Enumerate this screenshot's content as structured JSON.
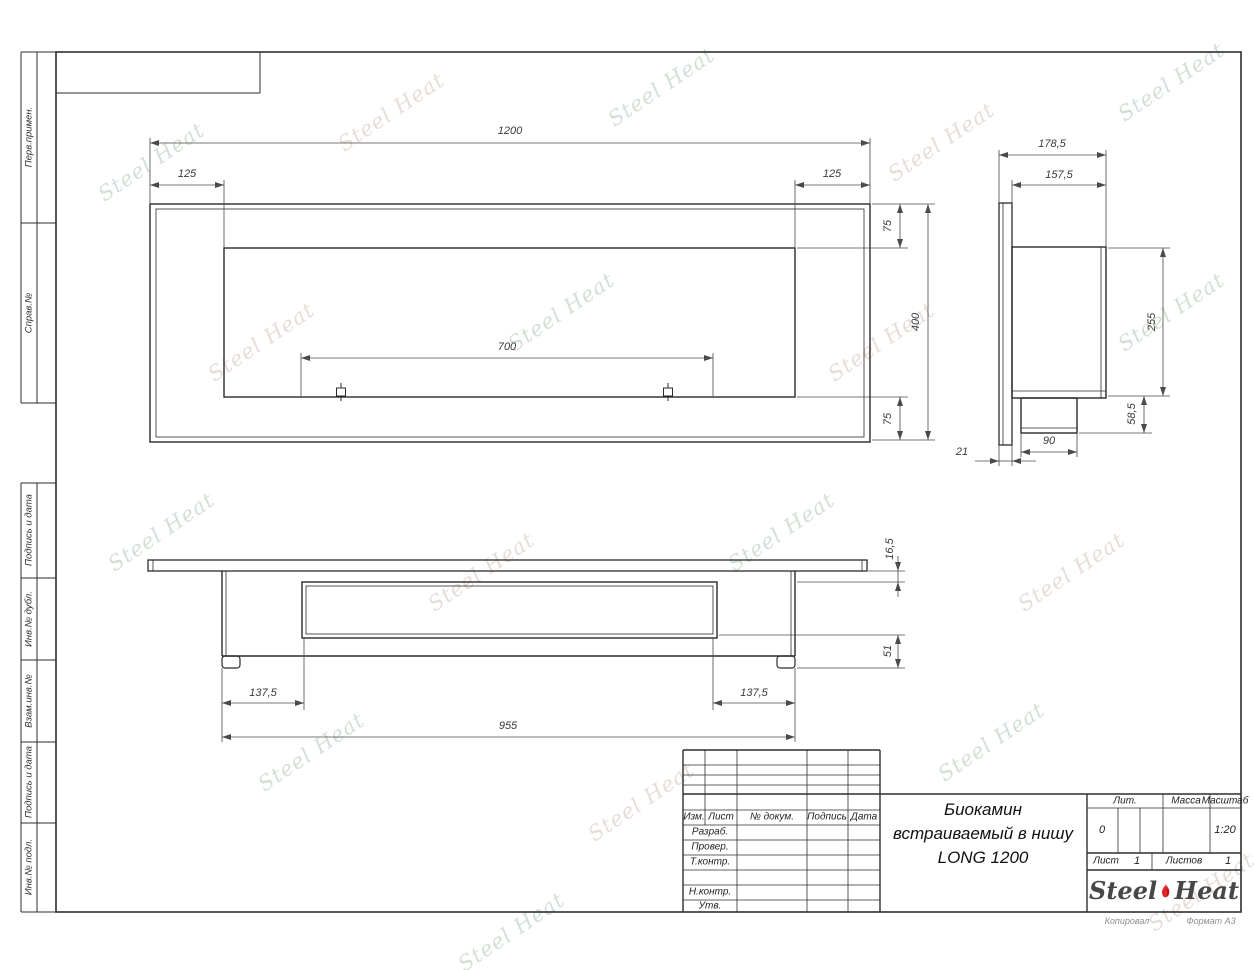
{
  "watermark": {
    "text": "Steel Heat"
  },
  "frame": {
    "left_labels": [
      {
        "text": "Перв.примен."
      },
      {
        "text": "Справ.№"
      },
      {
        "text": "Подпись и дата"
      },
      {
        "text": "Инв.№ дубл."
      },
      {
        "text": "Взам.инв.№"
      },
      {
        "text": "Подпись и дата"
      },
      {
        "text": "Инв.№ подл."
      }
    ],
    "footer": {
      "left": "Копировал",
      "right": "Формат А3"
    }
  },
  "views": {
    "front": {
      "dims": {
        "overall_width": "1200",
        "left_offset": "125",
        "right_offset": "125",
        "burner_length": "700",
        "top_border": "75",
        "height": "400",
        "bottom_border": "75"
      }
    },
    "side": {
      "dims": {
        "overall_depth": "178,5",
        "body_depth": "157,5",
        "body_height": "255",
        "burner_height": "58,5",
        "burner_width": "90",
        "flange_thickness": "21"
      }
    },
    "bottom": {
      "dims": {
        "plate_thickness": "16,5",
        "lower_height": "51",
        "left_inset": "137,5",
        "right_inset": "137,5",
        "body_width": "955"
      }
    }
  },
  "title_block": {
    "rev_header": {
      "izm": "Изм.",
      "list": "Лист",
      "doc": "№ докум.",
      "sign": "Подпись",
      "date": "Дата"
    },
    "rows": {
      "razrab": "Разраб.",
      "prover": "Провер.",
      "tkontr": "Т.контр.",
      "nkontr": "Н.контр.",
      "utv": "Утв."
    },
    "title_lines": [
      "Биокамин",
      "встраиваемый в нишу",
      "LONG 1200"
    ],
    "lit_label": "Лит.",
    "lit_value": "0",
    "massa_label": "Масса",
    "scale_label": "Масштаб",
    "scale_value": "1:20",
    "sheet_label": "Лист",
    "sheet_value": "1",
    "sheets_label": "Листов",
    "sheets_value": "1",
    "logo": {
      "steel": "Steel",
      "heat": "Heat"
    },
    "colors": {
      "flame_red": "#e02428",
      "flame_dark": "#9e1a1c",
      "logo_gray": "#474747"
    }
  }
}
